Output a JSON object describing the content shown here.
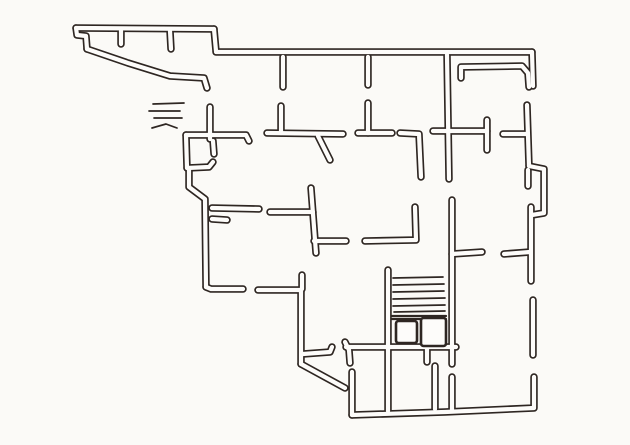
{
  "diagram": {
    "type": "floor-plan-sketch",
    "style": "hand-drawn-ink-on-paper",
    "canvas": {
      "width": 630,
      "height": 445
    },
    "colors": {
      "paper": "#fbfaf7",
      "ink": "#2e2622",
      "wall_core": "#fdfcfa"
    },
    "stroke_widths": {
      "wall_outer": 7.5,
      "wall_inner": 4.2,
      "thin_line": 1.7,
      "heavy_line": 2.2,
      "box_outline": 2.6
    },
    "walls": [
      {
        "name": "wing-top-wall",
        "points": [
          [
            76,
            28
          ],
          [
            214,
            29
          ]
        ]
      },
      {
        "name": "wing-left-cap",
        "points": [
          [
            76,
            28
          ],
          [
            77,
            35
          ],
          [
            86,
            36
          ],
          [
            87,
            49
          ]
        ]
      },
      {
        "name": "wing-slanted-wall",
        "points": [
          [
            87,
            49
          ],
          [
            128,
            63
          ],
          [
            170,
            76
          ],
          [
            204,
            78
          ],
          [
            207,
            88
          ]
        ]
      },
      {
        "name": "wing-stub-a",
        "points": [
          [
            121,
            31
          ],
          [
            121,
            44
          ]
        ]
      },
      {
        "name": "wing-stub-b",
        "points": [
          [
            170,
            31
          ],
          [
            171,
            49
          ]
        ]
      },
      {
        "name": "top-step-joint",
        "points": [
          [
            214,
            29
          ],
          [
            216,
            51
          ]
        ]
      },
      {
        "name": "main-top-wall",
        "points": [
          [
            216,
            52
          ],
          [
            532,
            52
          ]
        ]
      },
      {
        "name": "top-right-corner",
        "points": [
          [
            532,
            52
          ],
          [
            533,
            86
          ]
        ]
      },
      {
        "name": "top-right-inner-room",
        "points": [
          [
            461,
            78
          ],
          [
            461,
            67
          ],
          [
            522,
            66
          ],
          [
            528,
            73
          ],
          [
            529,
            87
          ]
        ]
      },
      {
        "name": "top-row-stub-a",
        "points": [
          [
            283,
            57
          ],
          [
            283,
            87
          ]
        ]
      },
      {
        "name": "top-row-stub-b",
        "points": [
          [
            368,
            57
          ],
          [
            368,
            85
          ]
        ]
      },
      {
        "name": "left-pier-upper",
        "points": [
          [
            210,
            107
          ],
          [
            210,
            139
          ]
        ]
      },
      {
        "name": "left-pier-hook",
        "points": [
          [
            213,
            141
          ],
          [
            214,
            154
          ]
        ]
      },
      {
        "name": "row2-wall-left-segment",
        "points": [
          [
            186,
            135
          ],
          [
            246,
            135
          ],
          [
            249,
            141
          ]
        ]
      },
      {
        "name": "bay-left-wall",
        "points": [
          [
            186,
            135
          ],
          [
            187,
            168
          ]
        ]
      },
      {
        "name": "bay-bottom-wall",
        "points": [
          [
            187,
            168
          ],
          [
            209,
            167
          ],
          [
            213,
            162
          ]
        ]
      },
      {
        "name": "left-outer-wall",
        "points": [
          [
            189,
            170
          ],
          [
            189,
            187
          ],
          [
            205,
            199
          ],
          [
            206,
            287
          ]
        ]
      },
      {
        "name": "left-wing-bottom-wall",
        "points": [
          [
            206,
            287
          ],
          [
            211,
            289
          ],
          [
            243,
            289
          ]
        ]
      },
      {
        "name": "row2-wall-mid-segment",
        "points": [
          [
            267,
            133
          ],
          [
            343,
            134
          ]
        ]
      },
      {
        "name": "row2-pier-a",
        "points": [
          [
            281,
            106
          ],
          [
            281,
            133
          ]
        ]
      },
      {
        "name": "row2-diagonal-stub",
        "points": [
          [
            318,
            136
          ],
          [
            330,
            160
          ]
        ]
      },
      {
        "name": "row2-wall-segment-c",
        "points": [
          [
            358,
            133
          ],
          [
            392,
            133
          ]
        ]
      },
      {
        "name": "row2-pier-b",
        "points": [
          [
            368,
            103
          ],
          [
            368,
            133
          ]
        ]
      },
      {
        "name": "row2-corner-wall",
        "points": [
          [
            400,
            133
          ],
          [
            419,
            134
          ],
          [
            421,
            177
          ]
        ]
      },
      {
        "name": "row2-wall-segment-d",
        "points": [
          [
            433,
            131
          ],
          [
            487,
            131
          ]
        ]
      },
      {
        "name": "center-cross-wall",
        "points": [
          [
            447,
            55
          ],
          [
            449,
            179
          ]
        ]
      },
      {
        "name": "door-jamb-stub",
        "points": [
          [
            487,
            120
          ],
          [
            487,
            150
          ]
        ]
      },
      {
        "name": "row2-wall-right-segment",
        "points": [
          [
            503,
            134
          ],
          [
            527,
            134
          ]
        ]
      },
      {
        "name": "right-wall-segment-a",
        "points": [
          [
            527,
            105
          ],
          [
            529,
            166
          ]
        ]
      },
      {
        "name": "right-wall-bump-out",
        "points": [
          [
            529,
            166
          ],
          [
            544,
            169
          ],
          [
            544,
            213
          ],
          [
            532,
            215
          ]
        ]
      },
      {
        "name": "right-wall-tongue",
        "points": [
          [
            528,
            170
          ],
          [
            528,
            186
          ]
        ]
      },
      {
        "name": "right-wall-segment-b",
        "points": [
          [
            531,
            207
          ],
          [
            531,
            281
          ]
        ]
      },
      {
        "name": "right-room-wall",
        "points": [
          [
            504,
            254
          ],
          [
            530,
            252
          ]
        ]
      },
      {
        "name": "right-wall-segment-c",
        "points": [
          [
            533,
            300
          ],
          [
            533,
            355
          ]
        ]
      },
      {
        "name": "bottom-right-corner-wall",
        "points": [
          [
            534,
            377
          ],
          [
            534,
            408
          ],
          [
            445,
            412
          ],
          [
            352,
            415
          ]
        ]
      },
      {
        "name": "left-room-arm-long",
        "points": [
          [
            212,
            208
          ],
          [
            259,
            209
          ]
        ]
      },
      {
        "name": "left-room-arm-short",
        "points": [
          [
            212,
            219
          ],
          [
            227,
            220
          ]
        ]
      },
      {
        "name": "mid-tee-vertical",
        "points": [
          [
            311,
            188
          ],
          [
            316,
            253
          ]
        ]
      },
      {
        "name": "mid-tee-arm-left",
        "points": [
          [
            270,
            212
          ],
          [
            313,
            212
          ]
        ]
      },
      {
        "name": "mid-tee-arm-right",
        "points": [
          [
            314,
            241
          ],
          [
            346,
            241
          ]
        ]
      },
      {
        "name": "mid-ell-wall",
        "points": [
          [
            415,
            207
          ],
          [
            416,
            240
          ],
          [
            365,
            241
          ]
        ]
      },
      {
        "name": "stair-right-wall",
        "points": [
          [
            452,
            200
          ],
          [
            452,
            364
          ]
        ]
      },
      {
        "name": "stair-right-arm",
        "points": [
          [
            452,
            254
          ],
          [
            482,
            252
          ]
        ]
      },
      {
        "name": "corner-jamb-stub",
        "points": [
          [
            302,
            275
          ],
          [
            302,
            289
          ]
        ]
      },
      {
        "name": "lower-wing-top-wall",
        "points": [
          [
            258,
            290
          ],
          [
            300,
            290
          ]
        ]
      },
      {
        "name": "lower-left-outer-wall",
        "points": [
          [
            301,
            291
          ],
          [
            301,
            364
          ]
        ]
      },
      {
        "name": "bottom-left-diagonal",
        "points": [
          [
            301,
            364
          ],
          [
            345,
            388
          ]
        ]
      },
      {
        "name": "bottom-left-return-wall",
        "points": [
          [
            352,
            372
          ],
          [
            352,
            415
          ]
        ]
      },
      {
        "name": "stair-right-wall-lower",
        "points": [
          [
            452,
            377
          ],
          [
            452,
            410
          ]
        ]
      },
      {
        "name": "lower-branch-arm",
        "points": [
          [
            303,
            354
          ],
          [
            330,
            352
          ],
          [
            332,
            347
          ]
        ]
      },
      {
        "name": "corridor-wall-end-hook",
        "points": [
          [
            345,
            342
          ],
          [
            349,
            350
          ],
          [
            350,
            363
          ]
        ]
      },
      {
        "name": "corridor-wall",
        "points": [
          [
            346,
            347
          ],
          [
            456,
            347
          ]
        ]
      },
      {
        "name": "corridor-nub",
        "points": [
          [
            427,
            347
          ],
          [
            427,
            362
          ]
        ]
      },
      {
        "name": "stair-left-wall",
        "points": [
          [
            388,
            270
          ],
          [
            388,
            411
          ]
        ]
      },
      {
        "name": "lower-room-divider",
        "points": [
          [
            435,
            366
          ],
          [
            435,
            409
          ]
        ]
      }
    ],
    "hatch_marks": [
      {
        "name": "hatch-line-1",
        "points": [
          [
            153,
            104
          ],
          [
            184,
            103
          ]
        ]
      },
      {
        "name": "hatch-line-2",
        "points": [
          [
            149,
            111
          ],
          [
            180,
            111
          ]
        ]
      },
      {
        "name": "hatch-line-3",
        "points": [
          [
            154,
            118
          ],
          [
            182,
            118
          ]
        ]
      },
      {
        "name": "hatch-line-4",
        "points": [
          [
            152,
            128
          ],
          [
            166,
            124
          ],
          [
            177,
            128
          ]
        ]
      }
    ],
    "stair_treads": [
      {
        "name": "tread-1",
        "points": [
          [
            393,
            278
          ],
          [
            443,
            277
          ]
        ]
      },
      {
        "name": "tread-2",
        "points": [
          [
            393,
            285
          ],
          [
            444,
            284
          ]
        ]
      },
      {
        "name": "tread-3",
        "points": [
          [
            393,
            292
          ],
          [
            444,
            291
          ]
        ]
      },
      {
        "name": "tread-4",
        "points": [
          [
            393,
            299
          ],
          [
            445,
            298
          ]
        ]
      },
      {
        "name": "tread-5",
        "points": [
          [
            393,
            306
          ],
          [
            445,
            305
          ]
        ]
      },
      {
        "name": "tread-6",
        "points": [
          [
            394,
            312
          ],
          [
            445,
            311
          ]
        ]
      }
    ],
    "stair_landing_lines": [
      {
        "name": "landing-edge-1",
        "points": [
          [
            392,
            316
          ],
          [
            446,
            316
          ]
        ]
      },
      {
        "name": "landing-edge-2",
        "points": [
          [
            392,
            319
          ],
          [
            446,
            319
          ]
        ]
      }
    ],
    "under_stair_boxes": [
      {
        "name": "under-stair-box-left",
        "x": 396,
        "y": 321,
        "w": 21,
        "h": 22
      },
      {
        "name": "under-stair-box-right",
        "x": 421,
        "y": 318,
        "w": 25,
        "h": 28
      }
    ]
  }
}
